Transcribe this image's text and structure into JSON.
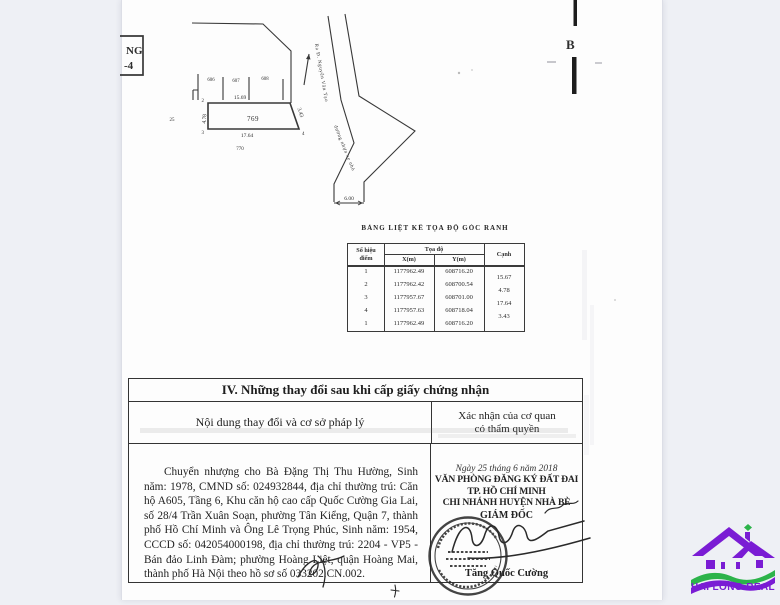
{
  "colors": {
    "background": "#eef0f5",
    "paper": "#fdfdfd",
    "ink": "#2e2e2e",
    "logo_purple": "#7a1cd4",
    "logo_green": "#2cb34a"
  },
  "corner_stamp": {
    "line1": "NG",
    "line2": "-4"
  },
  "edge_marker": {
    "label": "B"
  },
  "sketch": {
    "plot_main": "769",
    "plot_below": "770",
    "plot_left": "25",
    "plots_top": [
      "606",
      "607",
      "608"
    ],
    "dim_top": "15.69",
    "dim_left": "4.78",
    "dim_bottom": "17.64",
    "dim_right": "3.43",
    "road_width": "6.00",
    "pt_top_left": "2",
    "pt_bottom_left": "3",
    "pt_bottom_right": "4",
    "alley_label": "Ra Đ. Nguyễn Văn Tạo",
    "road_label": "đường nhựa xe nhỏ"
  },
  "coord_table": {
    "title": "BẢNG LIỆT KÊ TỌA ĐỘ GÓC RANH",
    "col_point_1": "Số hiệu",
    "col_point_2": "điểm",
    "col_coords": "Tọa độ",
    "col_x": "X(m)",
    "col_y": "Y(m)",
    "col_edge": "Cạnh",
    "rows": [
      {
        "p": "1",
        "x": "1177962.49",
        "y": "608716.20"
      },
      {
        "p": "2",
        "x": "1177962.42",
        "y": "608700.54"
      },
      {
        "p": "3",
        "x": "1177957.67",
        "y": "608701.00"
      },
      {
        "p": "4",
        "x": "1177957.63",
        "y": "608718.04"
      },
      {
        "p": "1",
        "x": "1177962.49",
        "y": "608716.20"
      }
    ],
    "edges": [
      "15.67",
      "4.78",
      "17.64",
      "3.43"
    ]
  },
  "section_iv": {
    "title": "IV. Những thay đổi sau khi cấp giấy chứng nhận",
    "col_content": "Nội dung thay đổi và cơ sở pháp lý",
    "col_confirm_1": "Xác nhận của cơ quan",
    "col_confirm_2": "có thẩm quyền",
    "content": "Chuyển nhượng cho Bà Đặng Thị Thu Hường, Sinh năm: 1978, CMND số: 024932844, địa chỉ thường trú: Căn hộ A605, Tầng 6, Khu căn hộ cao cấp Quốc Cường Gia Lai, số 28/4 Trần Xuân Soạn, phường Tân Kiểng, Quận 7, thành phố Hồ Chí Minh và Ông Lê Trọng Phúc, Sinh năm: 1954, CCCD số: 042054000198, địa chỉ thường trú: 2204 - VP5 - Bán đảo Linh Đàm; phường Hoàng Liệt, quận Hoàng Mai, thành phố Hà Nội theo hồ sơ số 033202.CN.002.",
    "date_line": "Ngày 25 tháng 6 năm 2018",
    "office_line1": "VĂN PHÒNG ĐĂNG KÝ ĐẤT ĐAI",
    "office_line2": "TP. HỒ CHÍ MINH",
    "office_line3": "CHI NHÁNH HUYỆN NHÀ BÈ",
    "signer_title": "GIÁM ĐỐC",
    "signer_name": "Tăng Quốc Cường"
  },
  "logo": {
    "text": "HAI LONG REAL"
  }
}
